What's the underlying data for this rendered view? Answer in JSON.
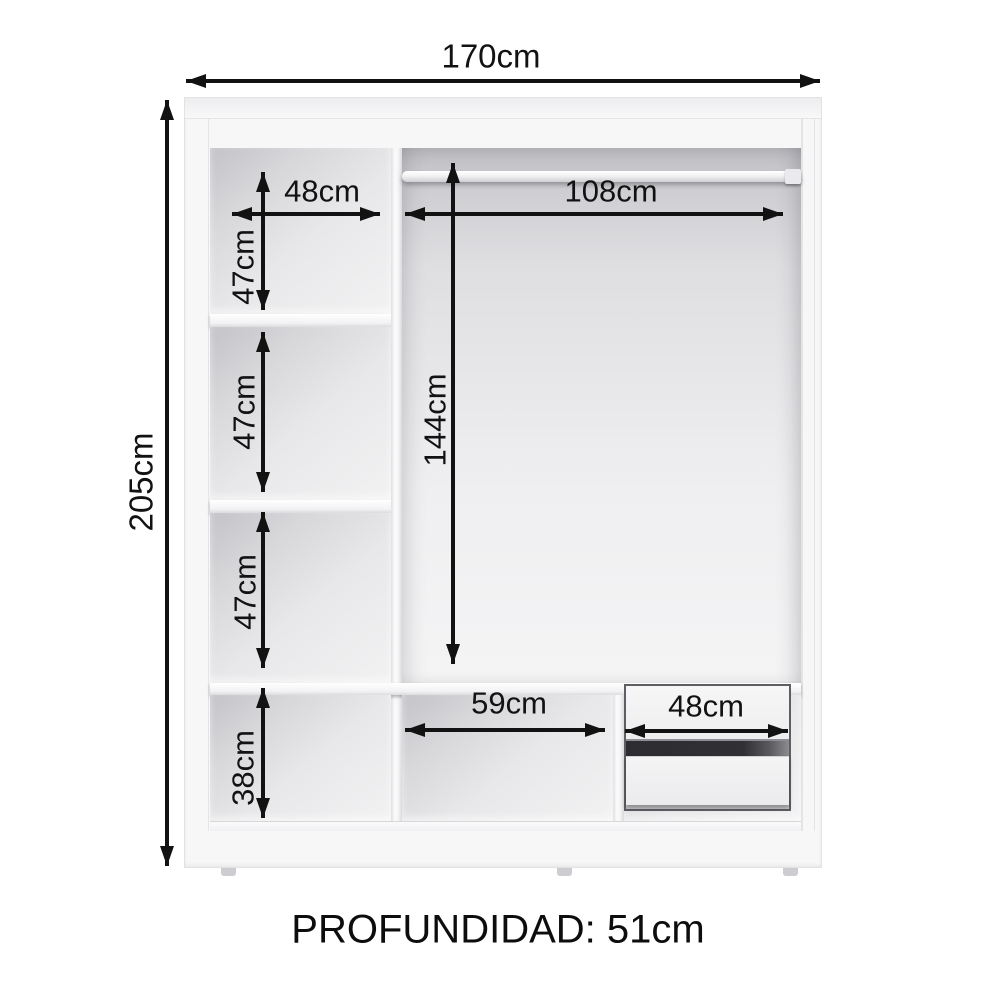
{
  "diagram": {
    "labels": {
      "total_width": "170cm",
      "total_height": "205cm",
      "left_column_width": "48cm",
      "left_compartment_1_height": "47cm",
      "left_compartment_2_height": "47cm",
      "left_compartment_3_height": "47cm",
      "hanging_width": "108cm",
      "hanging_height": "144cm",
      "bottom_compartment_height": "38cm",
      "bottom_middle_width": "59cm",
      "drawer_width": "48cm",
      "depth": "PROFUNDIDAD: 51cm"
    }
  }
}
